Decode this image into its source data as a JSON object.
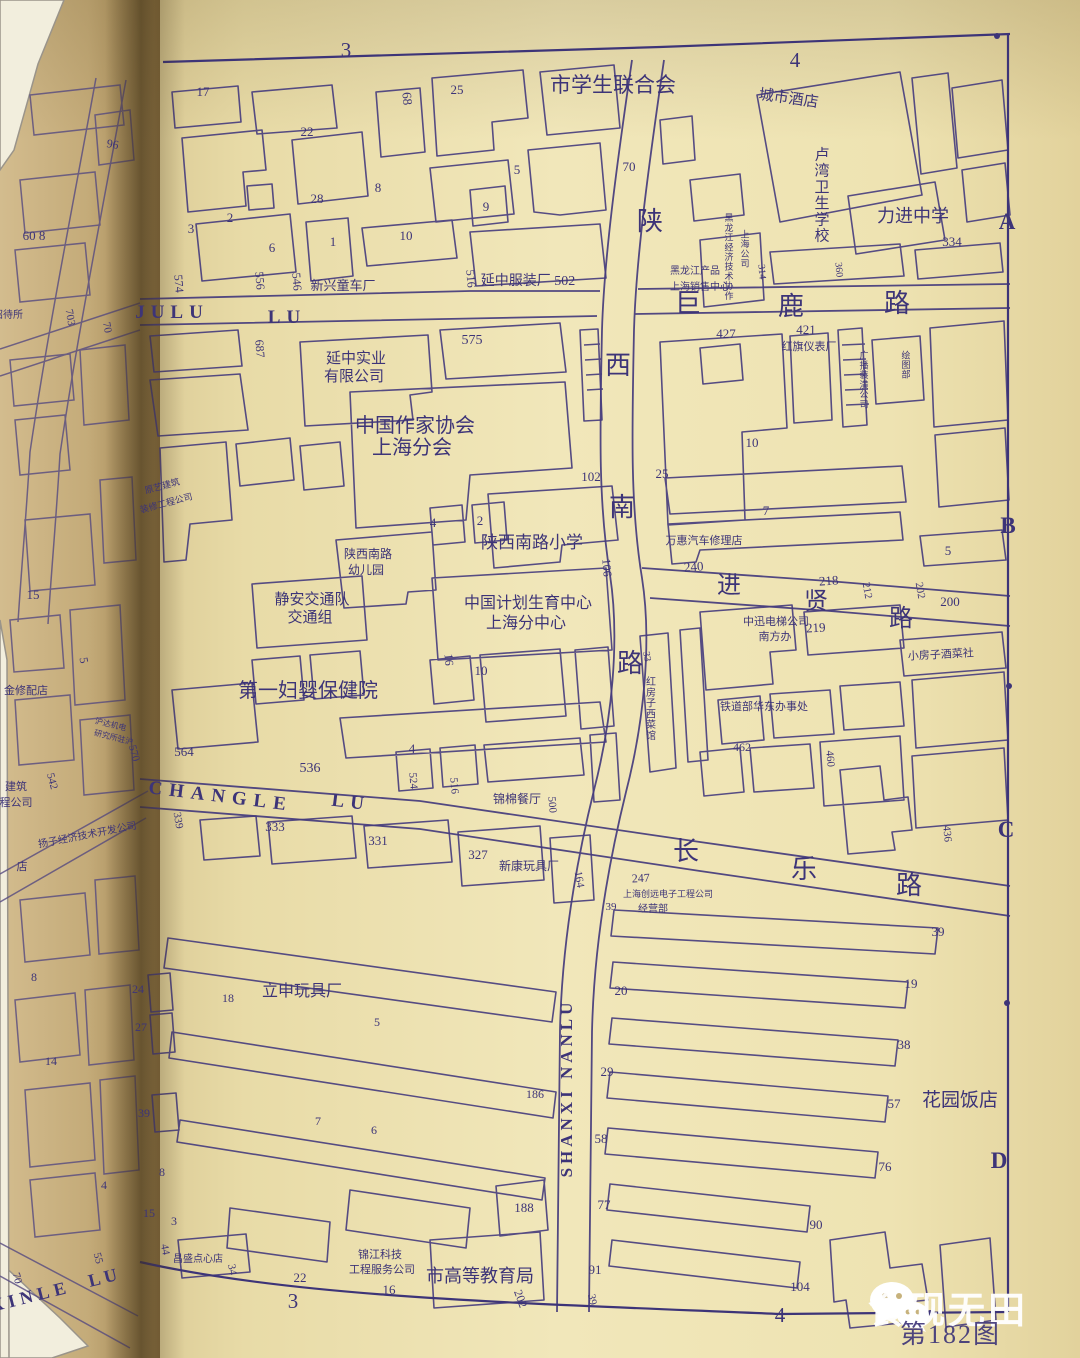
{
  "page": {
    "figure_caption": "第182图",
    "watermark_text": "食砚无田"
  },
  "style": {
    "ink": "#3d3478",
    "paper_main": "#eee3b4",
    "paper_left": "#c9b183",
    "watermark": "#ffffff"
  },
  "map_labels": [
    {
      "t": "3",
      "x": 346,
      "y": 57,
      "s": 21,
      "k": "grid-label"
    },
    {
      "t": "4",
      "x": 795,
      "y": 67,
      "s": 21,
      "k": "grid-label"
    },
    {
      "t": "A",
      "x": 1007,
      "y": 229,
      "s": 23,
      "b": 1,
      "k": "grid-label"
    },
    {
      "t": "B",
      "x": 1008,
      "y": 533,
      "s": 23,
      "b": 1,
      "k": "grid-label"
    },
    {
      "t": "C",
      "x": 1006,
      "y": 837,
      "s": 23,
      "b": 1,
      "k": "grid-label"
    },
    {
      "t": "D",
      "x": 999,
      "y": 1168,
      "s": 23,
      "b": 1,
      "k": "grid-label"
    },
    {
      "t": "3",
      "x": 293,
      "y": 1308,
      "s": 21,
      "k": "grid-label"
    },
    {
      "t": "4",
      "x": 780,
      "y": 1322,
      "s": 21,
      "k": "grid-label"
    },
    {
      "t": "市学生联合会",
      "x": 613,
      "y": 92,
      "s": 21,
      "k": "place-label"
    },
    {
      "t": "城市酒店",
      "x": 788,
      "y": 103,
      "s": 15,
      "r": 8,
      "k": "place-label"
    },
    {
      "t": "卢湾卫生学校",
      "x": 822,
      "y": 200,
      "s": 15,
      "v": 1,
      "k": "place-label"
    },
    {
      "t": "力进中学",
      "x": 913,
      "y": 222,
      "s": 18,
      "k": "place-label"
    },
    {
      "t": "334",
      "x": 952,
      "y": 246,
      "s": 13,
      "k": "house-number"
    },
    {
      "t": "360",
      "x": 836,
      "y": 270,
      "s": 10,
      "r": 85,
      "k": "house-number"
    },
    {
      "t": "314",
      "x": 759,
      "y": 272,
      "s": 10,
      "r": 85,
      "k": "house-number"
    },
    {
      "t": "黑龙江经济技术协作",
      "x": 729,
      "y": 260,
      "s": 9,
      "v": 1,
      "k": "place-label"
    },
    {
      "t": "上海公司",
      "x": 745,
      "y": 252,
      "s": 9,
      "v": 1,
      "k": "place-label"
    },
    {
      "t": "黑龙江产品",
      "x": 695,
      "y": 274,
      "s": 10,
      "k": "place-label"
    },
    {
      "t": "上海销售中心",
      "x": 700,
      "y": 290,
      "s": 10,
      "k": "place-label"
    },
    {
      "t": "17",
      "x": 203,
      "y": 96,
      "s": 13,
      "k": "house-number"
    },
    {
      "t": "68",
      "x": 403,
      "y": 99,
      "s": 13,
      "r": 85,
      "k": "house-number"
    },
    {
      "t": "25",
      "x": 457,
      "y": 94,
      "s": 13,
      "k": "house-number"
    },
    {
      "t": "22",
      "x": 307,
      "y": 136,
      "s": 13,
      "k": "house-number"
    },
    {
      "t": "28",
      "x": 317,
      "y": 203,
      "s": 13,
      "k": "house-number"
    },
    {
      "t": "8",
      "x": 378,
      "y": 192,
      "s": 13,
      "k": "house-number"
    },
    {
      "t": "2",
      "x": 230,
      "y": 222,
      "s": 13,
      "k": "house-number"
    },
    {
      "t": "3",
      "x": 191,
      "y": 233,
      "s": 13,
      "k": "house-number"
    },
    {
      "t": "6",
      "x": 272,
      "y": 252,
      "s": 13,
      "k": "house-number"
    },
    {
      "t": "1",
      "x": 333,
      "y": 246,
      "s": 13,
      "k": "house-number"
    },
    {
      "t": "10",
      "x": 406,
      "y": 240,
      "s": 13,
      "k": "house-number"
    },
    {
      "t": "5",
      "x": 517,
      "y": 174,
      "s": 13,
      "k": "house-number"
    },
    {
      "t": "70",
      "x": 629,
      "y": 171,
      "s": 13,
      "k": "house-number"
    },
    {
      "t": "9",
      "x": 486,
      "y": 211,
      "s": 13,
      "k": "house-number"
    },
    {
      "t": "陕",
      "x": 650,
      "y": 230,
      "s": 26,
      "k": "road-name"
    },
    {
      "t": "新兴童车厂",
      "x": 343,
      "y": 290,
      "s": 13,
      "k": "place-label"
    },
    {
      "t": "574",
      "x": 175,
      "y": 284,
      "s": 12,
      "r": 85,
      "k": "house-number"
    },
    {
      "t": "556",
      "x": 256,
      "y": 281,
      "s": 12,
      "r": 85,
      "k": "house-number"
    },
    {
      "t": "546",
      "x": 293,
      "y": 282,
      "s": 12,
      "r": 85,
      "k": "house-number"
    },
    {
      "t": "516",
      "x": 467,
      "y": 279,
      "s": 12,
      "r": 85,
      "k": "house-number"
    },
    {
      "t": "延中服装厂 502",
      "x": 528,
      "y": 285,
      "s": 14,
      "k": "place-label"
    },
    {
      "t": "JULU",
      "x": 172,
      "y": 318,
      "s": 19,
      "b": 1,
      "ls": 6,
      "k": "road-name"
    },
    {
      "t": "LU",
      "x": 287,
      "y": 323,
      "s": 19,
      "b": 1,
      "ls": 6,
      "k": "road-name"
    },
    {
      "t": "巨",
      "x": 688,
      "y": 312,
      "s": 26,
      "k": "road-name"
    },
    {
      "t": "鹿",
      "x": 791,
      "y": 315,
      "s": 26,
      "k": "road-name"
    },
    {
      "t": "路",
      "x": 897,
      "y": 312,
      "s": 26,
      "k": "road-name"
    },
    {
      "t": "687",
      "x": 256,
      "y": 349,
      "s": 12,
      "r": 85,
      "k": "house-number"
    },
    {
      "t": "延中实业",
      "x": 356,
      "y": 363,
      "s": 15,
      "k": "place-label"
    },
    {
      "t": "有限公司",
      "x": 354,
      "y": 381,
      "s": 15,
      "k": "place-label"
    },
    {
      "t": "575",
      "x": 472,
      "y": 344,
      "s": 14,
      "k": "house-number"
    },
    {
      "t": "中国作家协会",
      "x": 415,
      "y": 432,
      "s": 20,
      "k": "place-label"
    },
    {
      "t": "上海分会",
      "x": 412,
      "y": 454,
      "s": 20,
      "k": "place-label"
    },
    {
      "t": "102",
      "x": 591,
      "y": 481,
      "s": 13,
      "k": "house-number"
    },
    {
      "t": "原艺建筑",
      "x": 163,
      "y": 489,
      "s": 9,
      "r": -15,
      "k": "place-label"
    },
    {
      "t": "装修工程公司",
      "x": 167,
      "y": 506,
      "s": 9,
      "r": -15,
      "k": "place-label"
    },
    {
      "t": "西",
      "x": 618,
      "y": 374,
      "s": 26,
      "k": "road-name"
    },
    {
      "t": "南",
      "x": 622,
      "y": 516,
      "s": 26,
      "k": "road-name"
    },
    {
      "t": "路",
      "x": 630,
      "y": 672,
      "s": 26,
      "k": "road-name"
    },
    {
      "t": "106",
      "x": 603,
      "y": 568,
      "s": 12,
      "r": 85,
      "k": "house-number"
    },
    {
      "t": "4",
      "x": 433,
      "y": 527,
      "s": 13,
      "k": "house-number"
    },
    {
      "t": "2",
      "x": 480,
      "y": 525,
      "s": 13,
      "k": "house-number"
    },
    {
      "t": "陕西南路",
      "x": 368,
      "y": 558,
      "s": 12,
      "k": "place-label"
    },
    {
      "t": "幼儿园",
      "x": 366,
      "y": 574,
      "s": 12,
      "k": "place-label"
    },
    {
      "t": "陕西南路小学",
      "x": 532,
      "y": 548,
      "s": 17,
      "k": "place-label"
    },
    {
      "t": "静安交通队",
      "x": 312,
      "y": 604,
      "s": 15,
      "k": "place-label"
    },
    {
      "t": "交通组",
      "x": 310,
      "y": 622,
      "s": 15,
      "k": "place-label"
    },
    {
      "t": "中国计划生育中心",
      "x": 528,
      "y": 608,
      "s": 16,
      "k": "place-label"
    },
    {
      "t": "上海分中心",
      "x": 526,
      "y": 628,
      "s": 16,
      "k": "place-label"
    },
    {
      "t": "16",
      "x": 445,
      "y": 660,
      "s": 12,
      "r": 85,
      "k": "house-number"
    },
    {
      "t": "10",
      "x": 481,
      "y": 675,
      "s": 13,
      "k": "house-number"
    },
    {
      "t": "第一妇婴保健院",
      "x": 308,
      "y": 697,
      "s": 20,
      "k": "place-label"
    },
    {
      "t": "564",
      "x": 184,
      "y": 756,
      "s": 13,
      "k": "house-number"
    },
    {
      "t": "536",
      "x": 310,
      "y": 772,
      "s": 14,
      "k": "house-number"
    },
    {
      "t": "4",
      "x": 412,
      "y": 753,
      "s": 13,
      "k": "house-number"
    },
    {
      "t": "524",
      "x": 410,
      "y": 781,
      "s": 11,
      "r": 85,
      "k": "house-number"
    },
    {
      "t": "516",
      "x": 451,
      "y": 786,
      "s": 11,
      "r": 85,
      "k": "house-number"
    },
    {
      "t": "锦棉餐厅",
      "x": 517,
      "y": 803,
      "s": 12,
      "k": "place-label"
    },
    {
      "t": "500",
      "x": 549,
      "y": 805,
      "s": 11,
      "r": 85,
      "k": "house-number"
    },
    {
      "t": "CHANGLE",
      "x": 220,
      "y": 802,
      "s": 19,
      "b": 1,
      "ls": 7,
      "r": 7,
      "k": "road-name"
    },
    {
      "t": "LU",
      "x": 350,
      "y": 808,
      "s": 19,
      "b": 1,
      "ls": 6,
      "r": 7,
      "k": "road-name"
    },
    {
      "t": "长",
      "x": 686,
      "y": 860,
      "s": 26,
      "k": "road-name"
    },
    {
      "t": "乐",
      "x": 804,
      "y": 878,
      "s": 26,
      "k": "road-name"
    },
    {
      "t": "路",
      "x": 909,
      "y": 894,
      "s": 26,
      "k": "road-name"
    },
    {
      "t": "339",
      "x": 175,
      "y": 821,
      "s": 11,
      "r": 80,
      "k": "house-number"
    },
    {
      "t": "333",
      "x": 275,
      "y": 831,
      "s": 13,
      "k": "house-number"
    },
    {
      "t": "331",
      "x": 378,
      "y": 845,
      "s": 13,
      "k": "house-number"
    },
    {
      "t": "327",
      "x": 478,
      "y": 859,
      "s": 13,
      "k": "house-number"
    },
    {
      "t": "新康玩具厂",
      "x": 529,
      "y": 870,
      "s": 12,
      "k": "place-label"
    },
    {
      "t": "164",
      "x": 576,
      "y": 880,
      "s": 11,
      "r": 80,
      "k": "house-number"
    },
    {
      "t": "进",
      "x": 729,
      "y": 593,
      "s": 24,
      "k": "road-name"
    },
    {
      "t": "贤",
      "x": 816,
      "y": 609,
      "s": 24,
      "k": "road-name"
    },
    {
      "t": "路",
      "x": 901,
      "y": 626,
      "s": 24,
      "k": "road-name"
    },
    {
      "t": "240",
      "x": 694,
      "y": 571,
      "s": 13,
      "r": -4,
      "k": "house-number"
    },
    {
      "t": "218",
      "x": 829,
      "y": 585,
      "s": 13,
      "r": -4,
      "k": "house-number"
    },
    {
      "t": "212",
      "x": 864,
      "y": 591,
      "s": 11,
      "r": 80,
      "k": "house-number"
    },
    {
      "t": "202",
      "x": 917,
      "y": 591,
      "s": 11,
      "r": 80,
      "k": "house-number"
    },
    {
      "t": "200",
      "x": 950,
      "y": 606,
      "s": 13,
      "k": "house-number"
    },
    {
      "t": "219",
      "x": 816,
      "y": 632,
      "s": 13,
      "r": -3,
      "k": "house-number"
    },
    {
      "t": "中迅电梯公司",
      "x": 776,
      "y": 625,
      "s": 11,
      "k": "place-label"
    },
    {
      "t": "南方办",
      "x": 775,
      "y": 640,
      "s": 11,
      "k": "place-label"
    },
    {
      "t": "小房子酒菜社",
      "x": 941,
      "y": 658,
      "s": 11,
      "r": -3,
      "k": "place-label"
    },
    {
      "t": "红房子西菜馆",
      "x": 651,
      "y": 712,
      "s": 10,
      "v": 1,
      "k": "place-label"
    },
    {
      "t": "33",
      "x": 644,
      "y": 657,
      "s": 10,
      "r": 80,
      "k": "house-number"
    },
    {
      "t": "铁道部华东办事处",
      "x": 764,
      "y": 710,
      "s": 11,
      "k": "place-label"
    },
    {
      "t": "462",
      "x": 742,
      "y": 751,
      "s": 12,
      "k": "house-number"
    },
    {
      "t": "460",
      "x": 827,
      "y": 759,
      "s": 11,
      "r": 85,
      "k": "house-number"
    },
    {
      "t": "436",
      "x": 944,
      "y": 834,
      "s": 11,
      "r": 85,
      "k": "house-number"
    },
    {
      "t": "427",
      "x": 726,
      "y": 338,
      "s": 13,
      "k": "house-number"
    },
    {
      "t": "421",
      "x": 806,
      "y": 334,
      "s": 13,
      "k": "house-number"
    },
    {
      "t": "红旗仪表厂",
      "x": 809,
      "y": 350,
      "s": 11,
      "k": "place-label"
    },
    {
      "t": "广播装潢公司",
      "x": 864,
      "y": 383,
      "s": 9,
      "v": 1,
      "k": "place-label"
    },
    {
      "t": "绘图部",
      "x": 906,
      "y": 368,
      "s": 9,
      "v": 1,
      "k": "place-label"
    },
    {
      "t": "10",
      "x": 752,
      "y": 447,
      "s": 13,
      "k": "house-number"
    },
    {
      "t": "25",
      "x": 662,
      "y": 478,
      "s": 13,
      "k": "house-number"
    },
    {
      "t": "7",
      "x": 766,
      "y": 515,
      "s": 13,
      "k": "house-number"
    },
    {
      "t": "5",
      "x": 948,
      "y": 555,
      "s": 13,
      "k": "house-number"
    },
    {
      "t": "万惠汽车修理店",
      "x": 704,
      "y": 544,
      "s": 11,
      "k": "place-label"
    },
    {
      "t": "SHANXI NANLU",
      "x": 572,
      "y": 1088,
      "s": 17,
      "b": 1,
      "ls": 4,
      "r": -90,
      "k": "road-name"
    },
    {
      "t": "247",
      "x": 641,
      "y": 882,
      "s": 12,
      "r": -3,
      "k": "house-number"
    },
    {
      "t": "上海创远电子工程公司",
      "x": 668,
      "y": 897,
      "s": 9,
      "k": "place-label"
    },
    {
      "t": "39",
      "x": 611,
      "y": 910,
      "s": 11,
      "k": "house-number"
    },
    {
      "t": "经营部",
      "x": 653,
      "y": 912,
      "s": 10,
      "k": "place-label"
    },
    {
      "t": "39",
      "x": 938,
      "y": 936,
      "s": 13,
      "k": "house-number"
    },
    {
      "t": "19",
      "x": 911,
      "y": 988,
      "s": 13,
      "k": "house-number"
    },
    {
      "t": "20",
      "x": 621,
      "y": 995,
      "s": 13,
      "k": "house-number"
    },
    {
      "t": "38",
      "x": 904,
      "y": 1049,
      "s": 13,
      "k": "house-number"
    },
    {
      "t": "29",
      "x": 607,
      "y": 1076,
      "s": 13,
      "k": "house-number"
    },
    {
      "t": "57",
      "x": 894,
      "y": 1108,
      "s": 13,
      "k": "house-number"
    },
    {
      "t": "58",
      "x": 601,
      "y": 1143,
      "s": 13,
      "k": "house-number"
    },
    {
      "t": "76",
      "x": 885,
      "y": 1171,
      "s": 13,
      "k": "house-number"
    },
    {
      "t": "77",
      "x": 604,
      "y": 1209,
      "s": 13,
      "k": "house-number"
    },
    {
      "t": "90",
      "x": 816,
      "y": 1229,
      "s": 13,
      "k": "house-number"
    },
    {
      "t": "91",
      "x": 595,
      "y": 1274,
      "s": 13,
      "k": "house-number"
    },
    {
      "t": "104",
      "x": 800,
      "y": 1291,
      "s": 13,
      "k": "house-number"
    },
    {
      "t": "39",
      "x": 589,
      "y": 1300,
      "s": 11,
      "r": 80,
      "k": "house-number"
    },
    {
      "t": "花园饭店",
      "x": 960,
      "y": 1106,
      "s": 19,
      "k": "place-label"
    },
    {
      "t": "立申玩具厂",
      "x": 302,
      "y": 996,
      "s": 16,
      "k": "place-label"
    },
    {
      "t": "18",
      "x": 228,
      "y": 1002,
      "s": 12,
      "k": "house-number"
    },
    {
      "t": "5",
      "x": 377,
      "y": 1026,
      "s": 12,
      "k": "house-number"
    },
    {
      "t": "186",
      "x": 535,
      "y": 1098,
      "s": 12,
      "k": "house-number"
    },
    {
      "t": "7",
      "x": 318,
      "y": 1125,
      "s": 12,
      "k": "house-number"
    },
    {
      "t": "6",
      "x": 374,
      "y": 1134,
      "s": 12,
      "k": "house-number"
    },
    {
      "t": "24",
      "x": 138,
      "y": 993,
      "s": 12,
      "k": "house-number"
    },
    {
      "t": "27",
      "x": 141,
      "y": 1031,
      "s": 12,
      "k": "house-number"
    },
    {
      "t": "39",
      "x": 144,
      "y": 1117,
      "s": 12,
      "k": "house-number"
    },
    {
      "t": "8",
      "x": 162,
      "y": 1176,
      "s": 12,
      "k": "house-number"
    },
    {
      "t": "15",
      "x": 149,
      "y": 1217,
      "s": 12,
      "k": "house-number"
    },
    {
      "t": "3",
      "x": 174,
      "y": 1225,
      "s": 12,
      "k": "house-number"
    },
    {
      "t": "44",
      "x": 162,
      "y": 1250,
      "s": 11,
      "r": 80,
      "k": "house-number"
    },
    {
      "t": "昌盛点心店",
      "x": 198,
      "y": 1262,
      "s": 10,
      "k": "place-label"
    },
    {
      "t": "34",
      "x": 229,
      "y": 1270,
      "s": 11,
      "r": 80,
      "k": "house-number"
    },
    {
      "t": "22",
      "x": 300,
      "y": 1282,
      "s": 13,
      "k": "house-number"
    },
    {
      "t": "16",
      "x": 389,
      "y": 1294,
      "s": 13,
      "k": "house-number"
    },
    {
      "t": "锦江科技",
      "x": 380,
      "y": 1258,
      "s": 11,
      "k": "place-label"
    },
    {
      "t": "工程服务公司",
      "x": 382,
      "y": 1273,
      "s": 11,
      "k": "place-label"
    },
    {
      "t": "市高等教育局",
      "x": 480,
      "y": 1282,
      "s": 18,
      "k": "place-label"
    },
    {
      "t": "188",
      "x": 524,
      "y": 1212,
      "s": 13,
      "k": "house-number"
    },
    {
      "t": "202",
      "x": 517,
      "y": 1300,
      "s": 12,
      "r": 70,
      "k": "house-number"
    },
    {
      "t": "96",
      "x": 112,
      "y": 148,
      "s": 12,
      "r": 10,
      "k": "house-number"
    },
    {
      "t": "60 8",
      "x": 34,
      "y": 240,
      "s": 13,
      "k": "house-number"
    },
    {
      "t": "703",
      "x": 67,
      "y": 318,
      "s": 11,
      "r": 80,
      "k": "house-number"
    },
    {
      "t": "70",
      "x": 104,
      "y": 328,
      "s": 11,
      "r": 80,
      "k": "house-number"
    },
    {
      "t": "招待所",
      "x": 8,
      "y": 318,
      "s": 10,
      "k": "place-label"
    },
    {
      "t": "15",
      "x": 33,
      "y": 599,
      "s": 13,
      "k": "house-number"
    },
    {
      "t": "5",
      "x": 80,
      "y": 661,
      "s": 12,
      "r": 80,
      "k": "house-number"
    },
    {
      "t": "金修配店",
      "x": 26,
      "y": 694,
      "s": 11,
      "k": "place-label"
    },
    {
      "t": "沪达机电",
      "x": 110,
      "y": 727,
      "s": 8,
      "r": 14,
      "k": "place-label"
    },
    {
      "t": "研究所驻沪",
      "x": 113,
      "y": 740,
      "s": 8,
      "r": 14,
      "k": "place-label"
    },
    {
      "t": "542",
      "x": 49,
      "y": 782,
      "s": 11,
      "r": 75,
      "k": "house-number"
    },
    {
      "t": "570",
      "x": 131,
      "y": 754,
      "s": 11,
      "r": 75,
      "k": "house-number"
    },
    {
      "t": "建筑",
      "x": 16,
      "y": 790,
      "s": 11,
      "k": "place-label"
    },
    {
      "t": "程公司",
      "x": 16,
      "y": 806,
      "s": 11,
      "k": "place-label"
    },
    {
      "t": "扬子经济技术开发公司",
      "x": 88,
      "y": 838,
      "s": 10,
      "r": -11,
      "k": "place-label"
    },
    {
      "t": "店",
      "x": 22,
      "y": 870,
      "s": 11,
      "k": "place-label"
    },
    {
      "t": "8",
      "x": 34,
      "y": 981,
      "s": 12,
      "k": "house-number"
    },
    {
      "t": "14",
      "x": 51,
      "y": 1065,
      "s": 12,
      "k": "house-number"
    },
    {
      "t": "4",
      "x": 104,
      "y": 1189,
      "s": 12,
      "k": "house-number"
    },
    {
      "t": "55",
      "x": 95,
      "y": 1259,
      "s": 11,
      "r": 75,
      "k": "house-number"
    },
    {
      "t": "70",
      "x": 14,
      "y": 1279,
      "s": 11,
      "r": 75,
      "k": "house-number"
    },
    {
      "t": "XINLE",
      "x": 32,
      "y": 1302,
      "s": 18,
      "b": 1,
      "ls": 5,
      "r": -14,
      "k": "road-name"
    },
    {
      "t": "LU",
      "x": 106,
      "y": 1283,
      "s": 18,
      "b": 1,
      "ls": 4,
      "r": -14,
      "k": "road-name"
    }
  ]
}
